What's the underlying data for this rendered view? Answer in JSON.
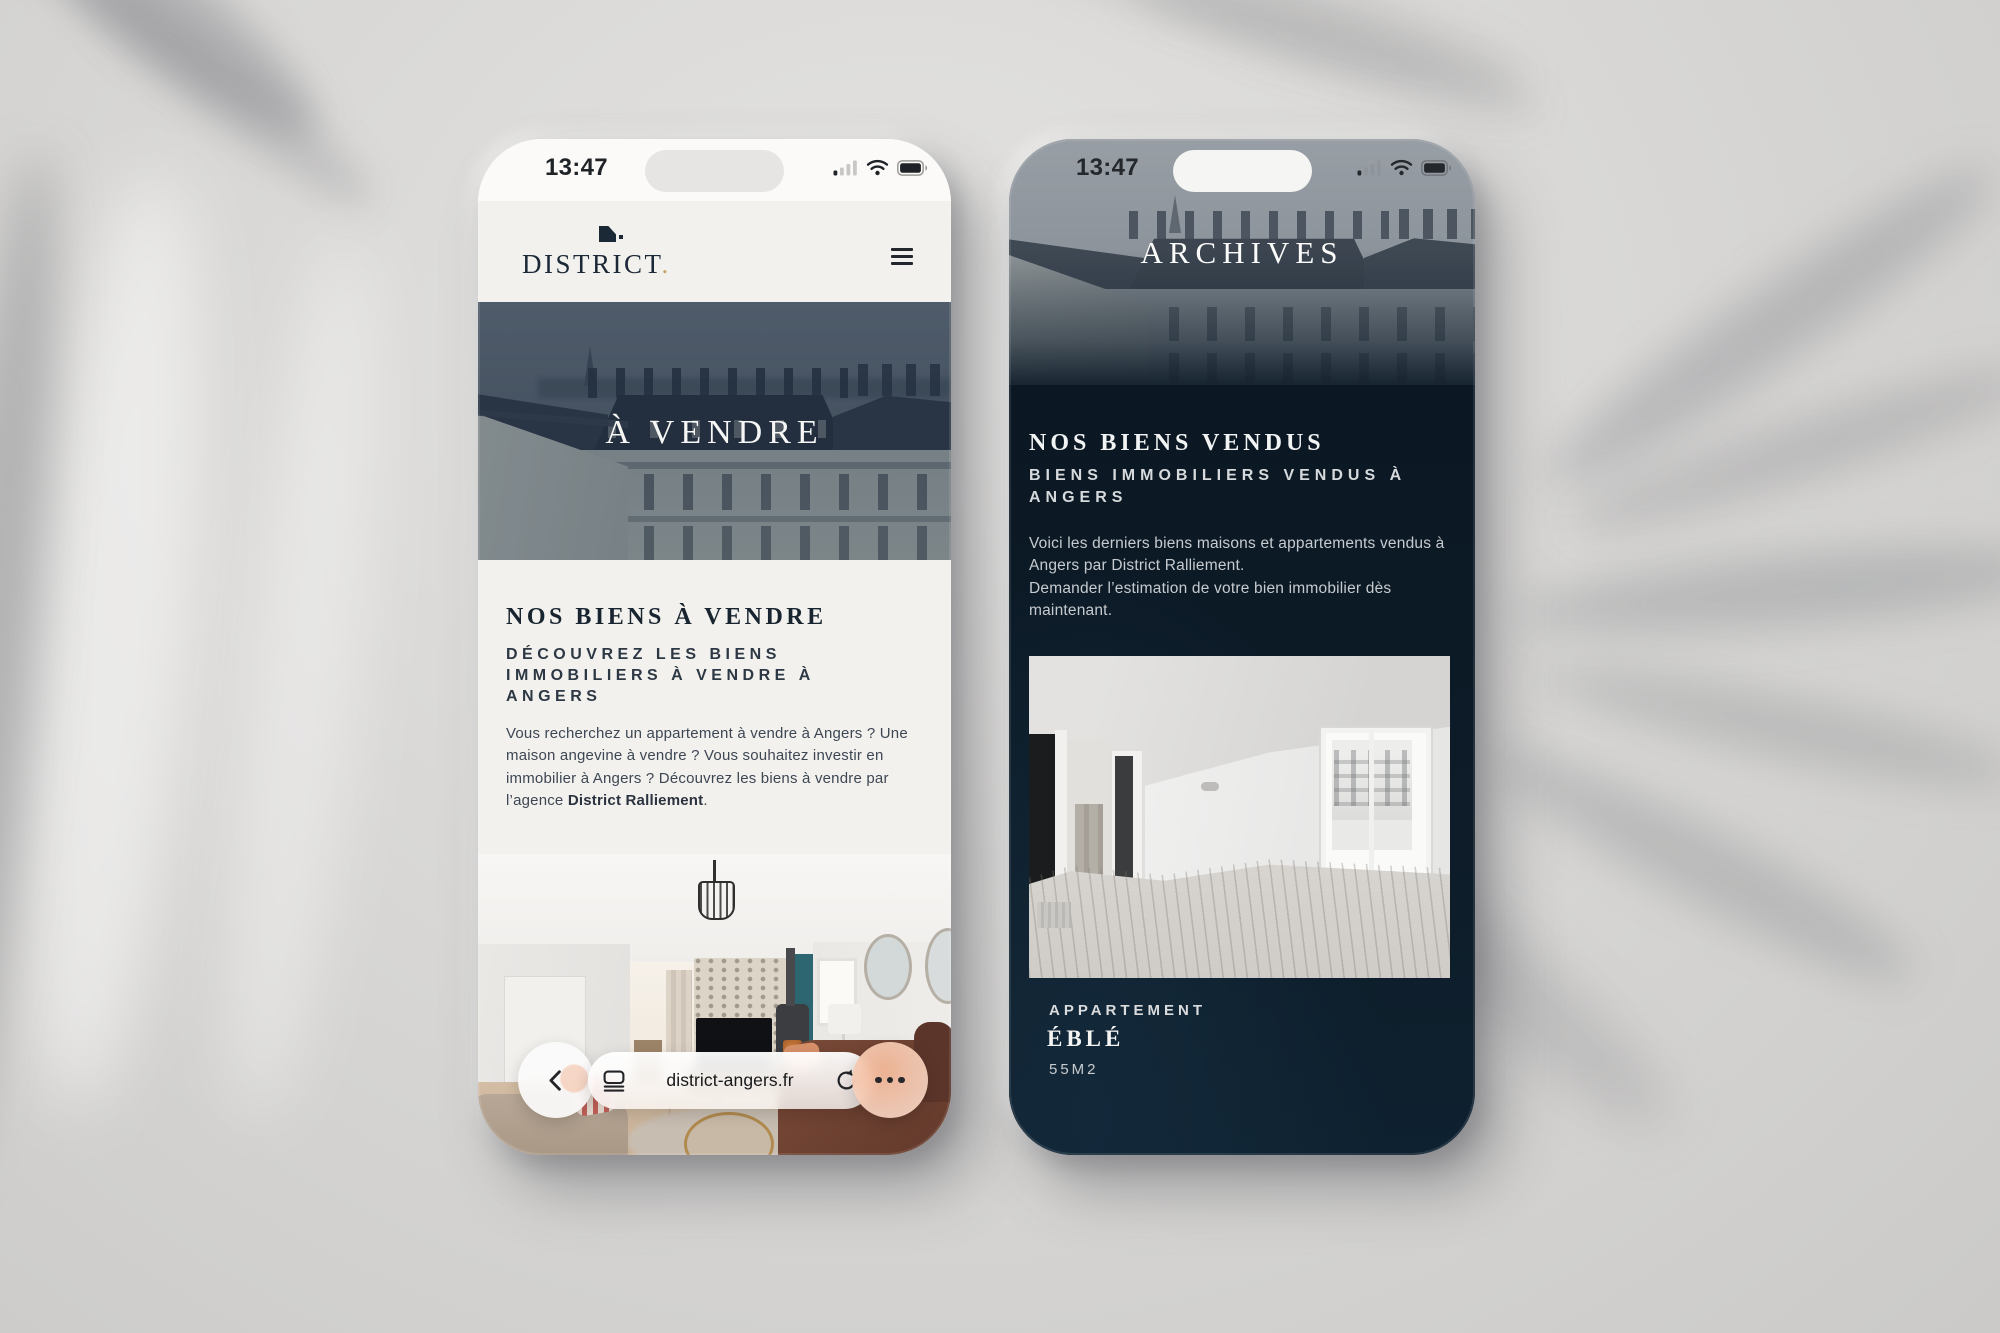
{
  "left_phone": {
    "status_bar": {
      "time": "13:47"
    },
    "header": {
      "brand": "DISTRICT",
      "brand_suffix": "."
    },
    "hero": {
      "title": "À VENDRE"
    },
    "section": {
      "heading": "NOS BIENS À VENDRE",
      "subheading": "DÉCOUVREZ LES BIENS IMMOBILIERS À VENDRE À ANGERS",
      "paragraph": {
        "text": "Vous recherchez un appartement à vendre à Angers ? Une maison angevine à vendre ? Vous souhaitez investir en immobilier à Angers ? Découvrez les biens à vendre par l’agence ",
        "bold": "District Ralliement",
        "suffix": "."
      }
    },
    "browser_bar": {
      "url": "district-angers.fr"
    }
  },
  "right_phone": {
    "status_bar": {
      "time": "13:47"
    },
    "hero": {
      "title": "ARCHIVES"
    },
    "section": {
      "heading": "NOS BIENS VENDUS",
      "subheading": "BIENS IMMOBILIERS VENDUS À ANGERS",
      "paragraph_lines": [
        "Voici les derniers biens maisons et appartements vendus à Angers par District Ralliement.",
        "Demander l’estimation de votre bien immobilier dès maintenant."
      ]
    },
    "listing": {
      "category": "APPARTEMENT",
      "name": "ÉBLÉ",
      "area": "55M2"
    }
  },
  "icons": {
    "hamburger": "menu",
    "back": "chevron-left",
    "reader": "page-reader",
    "refresh": "reload",
    "more": "ellipsis",
    "signal": "cellular-signal",
    "wifi": "wifi",
    "battery": "battery-full",
    "brand_mark": "district-flag-mark"
  },
  "colors": {
    "navy_text": "#1b2836",
    "navy_background": "#0d1c28",
    "gold_accent": "#c9a36c",
    "paper": "#f3f1ee",
    "scene_background": "#d9d8d6",
    "hero_tint": "#3c4f63"
  }
}
